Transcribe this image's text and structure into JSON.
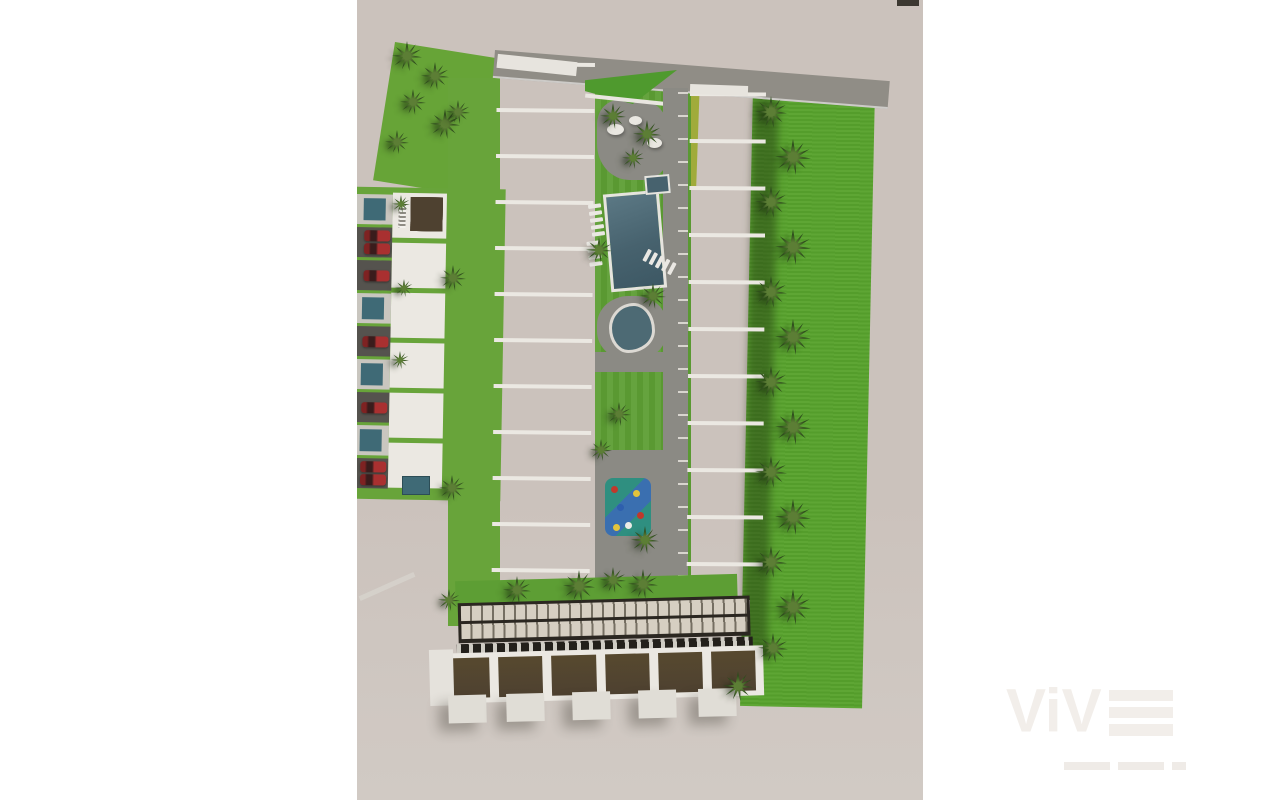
{
  "scene": {
    "type": "aerial-3d-architectural-render",
    "subject": "Top-down 3D rendering of a residential townhouse development with central pool courtyard, kidney pond, playground, palm trees, lawns, carports and parking with red cars",
    "watermark": {
      "brand": "ViV",
      "brand_last_letter": "E"
    }
  },
  "palette": {
    "ground": "#cbc2bc",
    "grass_bright": "#57a22c",
    "grass_mid": "#5d9e34",
    "grass_patch": "#67a437",
    "grass_band": "#68a43a",
    "chartreuse": "#a0ab3b",
    "roof": "#4e4130",
    "wall": "#ebe8e2",
    "terrace": "#24211b",
    "path": "#8b8a84",
    "road": "#908d86",
    "drive": "#55534e",
    "pool": "#47626e",
    "pond": "#4d6a74",
    "teal": "#3f6a76",
    "play_teal": "#2f8f80",
    "play_blue": "#3a6fb0",
    "car": "#a93030",
    "palm": "#2f4d1d",
    "palm_light": "#5c7e35",
    "slat": "#d6cfc2",
    "perg_dark": "#2b2721",
    "wm": "#f2eeea",
    "wm2": "#efebe7"
  },
  "figures": {
    "left_row_units": 12,
    "right_row_units": 11,
    "block_houses": 6,
    "bottom_houses": 6,
    "parking_slots": [
      "pool",
      "car2",
      "car",
      "pool",
      "car",
      "pool",
      "car",
      "pool",
      "car2"
    ],
    "garages_x": [
      18,
      76,
      142,
      208,
      268
    ],
    "palms": [
      [
        50,
        56,
        30
      ],
      [
        78,
        76,
        28
      ],
      [
        56,
        102,
        26
      ],
      [
        88,
        124,
        30
      ],
      [
        40,
        142,
        24
      ],
      [
        414,
        112,
        32
      ],
      [
        436,
        157,
        36
      ],
      [
        414,
        202,
        32
      ],
      [
        436,
        247,
        36
      ],
      [
        414,
        292,
        32
      ],
      [
        436,
        337,
        36
      ],
      [
        414,
        382,
        32
      ],
      [
        436,
        427,
        36
      ],
      [
        414,
        472,
        32
      ],
      [
        436,
        517,
        36
      ],
      [
        414,
        562,
        32
      ],
      [
        436,
        607,
        36
      ],
      [
        416,
        648,
        30
      ],
      [
        381,
        686,
        30
      ],
      [
        256,
        116,
        26
      ],
      [
        290,
        134,
        28
      ],
      [
        276,
        158,
        22
      ],
      [
        242,
        250,
        26
      ],
      [
        296,
        296,
        26
      ],
      [
        262,
        414,
        24
      ],
      [
        244,
        450,
        22
      ],
      [
        288,
        540,
        28
      ],
      [
        256,
        580,
        26
      ],
      [
        101,
        112,
        24
      ],
      [
        96,
        278,
        26
      ],
      [
        95,
        488,
        26
      ],
      [
        92,
        600,
        22
      ],
      [
        44,
        204,
        18
      ],
      [
        47,
        288,
        18
      ],
      [
        43,
        360,
        18
      ],
      [
        160,
        590,
        28
      ],
      [
        222,
        586,
        32
      ],
      [
        286,
        584,
        30
      ]
    ],
    "boulders": [
      [
        250,
        124,
        17,
        11
      ],
      [
        272,
        116,
        13,
        9
      ],
      [
        290,
        138,
        15,
        10
      ]
    ],
    "lounger_groups": [
      {
        "x": 233,
        "y": 204,
        "n": 5,
        "r": -8
      },
      {
        "x": 231,
        "y": 241,
        "n": 4,
        "r": -8
      },
      {
        "x": 296,
        "y": 246,
        "n": 5,
        "r": -62
      }
    ],
    "playground_dots": [
      [
        6,
        8,
        "#c0392b"
      ],
      [
        28,
        12,
        "#e2c43c"
      ],
      [
        12,
        26,
        "#2e5fae"
      ],
      [
        32,
        34,
        "#c0392b"
      ],
      [
        20,
        44,
        "#ecebe6"
      ],
      [
        8,
        46,
        "#e2c43c"
      ]
    ],
    "tagline_bar_widths": [
      46,
      46,
      14
    ]
  }
}
